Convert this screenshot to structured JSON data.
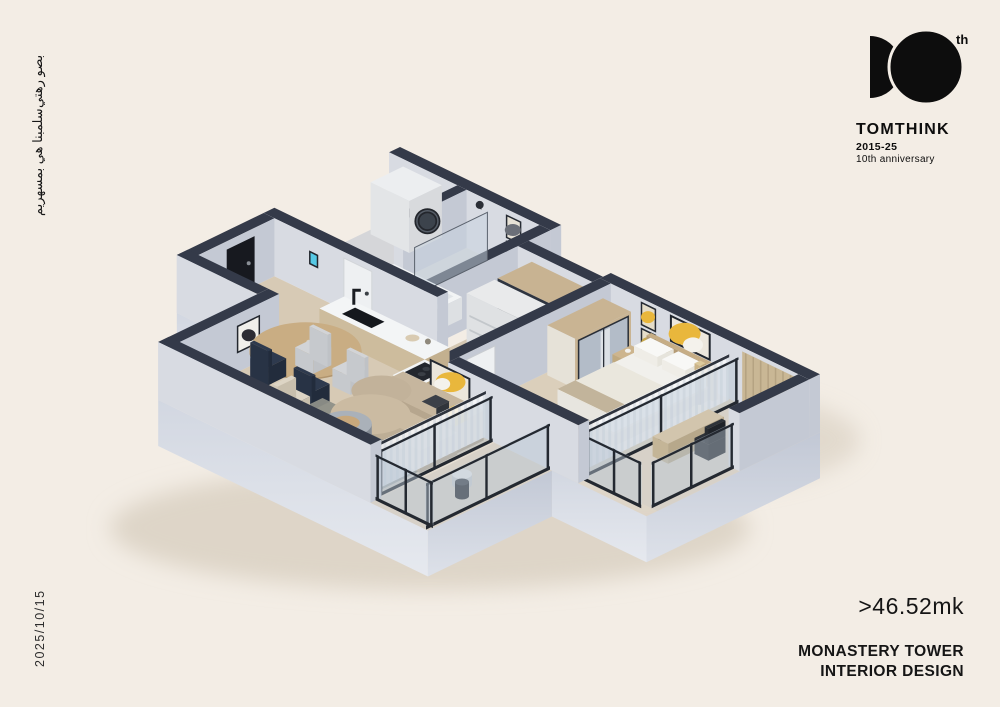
{
  "side_texts": {
    "arabic_line1": "بصو رهتي",
    "arabic_line2": "سلمبنا هي بمسهريم",
    "date": "2025/10/15"
  },
  "logo": {
    "th": "th",
    "brand": "TOMTHINK",
    "years": "2015-25",
    "anniversary": "10th anniversary"
  },
  "footer": {
    "area": ">46.52mk",
    "title_line1": "MONASTERY TOWER",
    "title_line2": "INTERIOR DESIGN"
  },
  "palette": {
    "background": "#f3ede5",
    "ink": "#0d0d0d",
    "wall_cap": "#343a49",
    "wall_light": "#d8dbe2",
    "wall_dark": "#c4c9d4",
    "floor_wood": "#d7cab5",
    "floor_bath": "#d5d6d9",
    "floor_bed": "#dbcfbb",
    "floor_balcony": "#d7d1c8",
    "wood": "#cdbc9d",
    "wood_dark": "#b9a685",
    "white_furniture": "#eef0f1",
    "navy_chair": "#2e3a4e",
    "sofa": "#bfae95",
    "sofa_light": "#cbbba2",
    "rug": "#8e8f88",
    "accent_yellow": "#e9b73c",
    "glass": "rgba(186,200,213,0.45)",
    "frame": "#242931",
    "curtain": "rgba(247,248,250,0.88)",
    "mirror": "#b3bcc8",
    "steel": "#9aa0a8",
    "cream_furniture": "#ddd5c5",
    "shadow": "#ded5c8"
  }
}
